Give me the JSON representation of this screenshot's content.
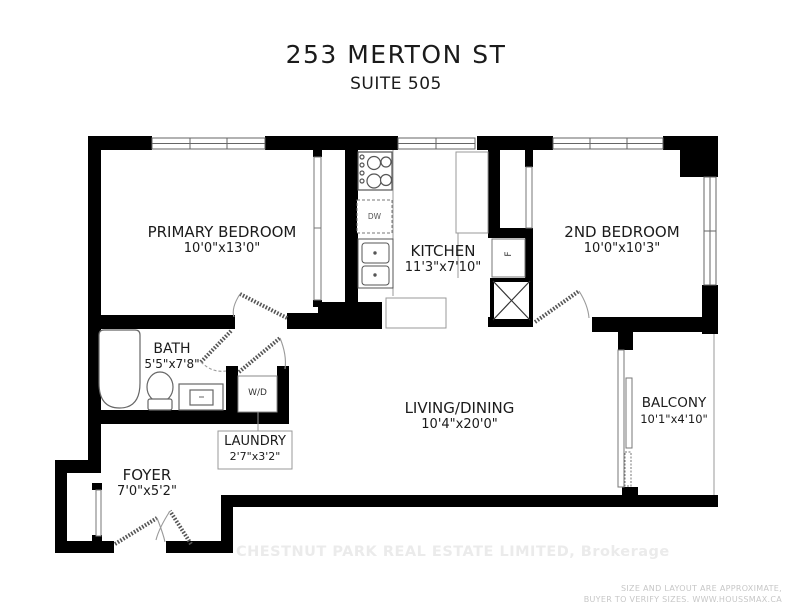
{
  "header": {
    "title": "253 MERTON ST",
    "subtitle": "SUITE 505"
  },
  "rooms": {
    "primary_bedroom": {
      "name": "PRIMARY BEDROOM",
      "dims": "10'0\"x13'0\""
    },
    "kitchen": {
      "name": "KITCHEN",
      "dims": "11'3\"x7'10\""
    },
    "second_bedroom": {
      "name": "2ND BEDROOM",
      "dims": "10'0\"x10'3\""
    },
    "bath": {
      "name": "BATH",
      "dims": "5'5\"x7'8\""
    },
    "laundry": {
      "name": "LAUNDRY",
      "dims": "2'7\"x3'2\""
    },
    "living_dining": {
      "name": "LIVING/DINING",
      "dims": "10'4\"x20'0\""
    },
    "balcony": {
      "name": "BALCONY",
      "dims": "10'1\"x4'10\""
    },
    "foyer": {
      "name": "FOYER",
      "dims": "7'0\"x5'2\""
    }
  },
  "fixtures": {
    "washer_dryer": "W/D",
    "dishwasher": "DW",
    "fridge": "F"
  },
  "footer": {
    "watermark": "CHESTNUT PARK REAL ESTATE LIMITED, Brokerage",
    "disclaimer_line1": "SIZE AND LAYOUT ARE APPROXIMATE,",
    "disclaimer_line2": "BUYER TO VERIFY SIZES. WWW.HOUSSMAX.CA"
  },
  "colors": {
    "wall": "#000000",
    "fixture_line": "#666666",
    "text": "#1b1b1b",
    "watermark": "#ebebeb",
    "disclaimer": "#c7c7c7"
  }
}
